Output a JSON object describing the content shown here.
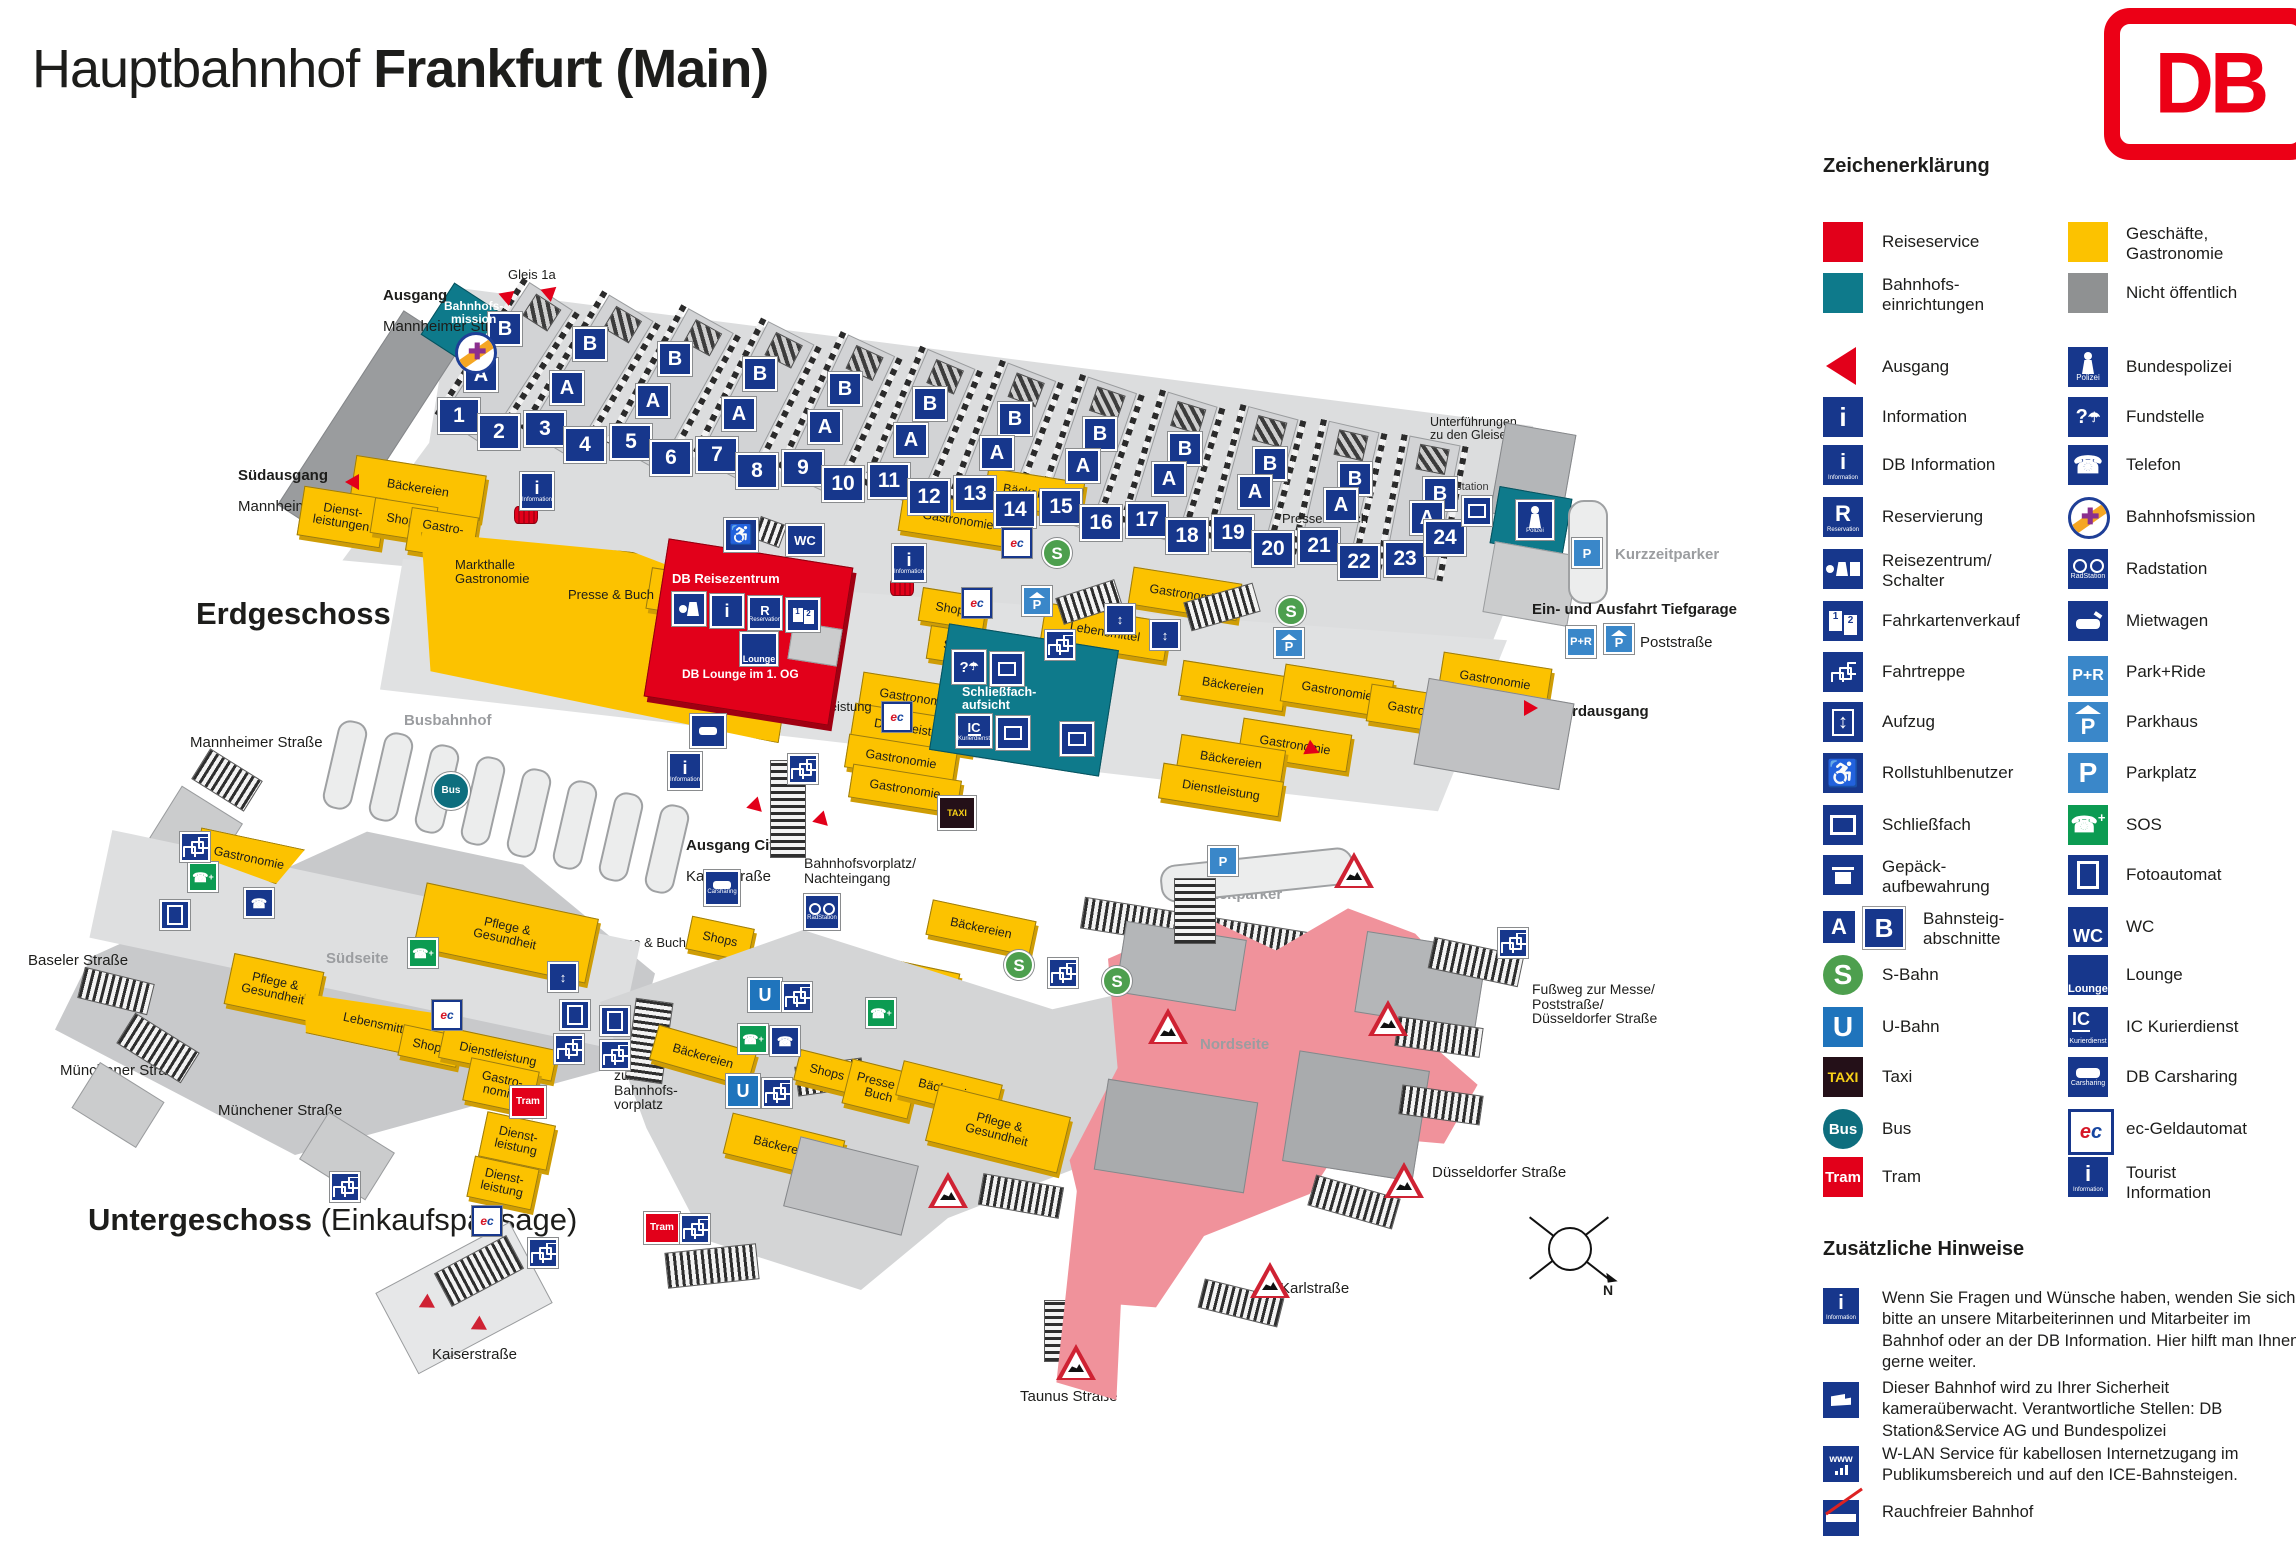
{
  "title": {
    "regular": "Hauptbahnhof ",
    "bold": "Frankfurt (Main)"
  },
  "logo": {
    "text": "DB"
  },
  "legend": {
    "heading": "Zeichenerklärung",
    "left": [
      {
        "icon": "reiseservice-swatch",
        "label": "Reiseservice"
      },
      {
        "icon": "bahnhofseinrichtungen-swatch",
        "label": "Bahnhofs-\neinrichtungen"
      },
      {
        "icon": "ausgang-arrow",
        "label": "Ausgang"
      },
      {
        "icon": "information",
        "label": "Information"
      },
      {
        "icon": "db-information",
        "label": "DB Information"
      },
      {
        "icon": "reservierung",
        "label": "Reservierung"
      },
      {
        "icon": "reisezentrum-schalter",
        "label": "Reisezentrum/\nSchalter"
      },
      {
        "icon": "fahrkartenverkauf",
        "label": "Fahrkartenverkauf"
      },
      {
        "icon": "fahrtreppe",
        "label": "Fahrtreppe"
      },
      {
        "icon": "aufzug",
        "label": "Aufzug"
      },
      {
        "icon": "rollstuhlbenutzer",
        "label": "Rollstuhlbenutzer"
      },
      {
        "icon": "schliessfach",
        "label": "Schließfach"
      },
      {
        "icon": "gepaeckaufbewahrung",
        "label": "Gepäck-\naufbewahrung"
      },
      {
        "icon": "bahnsteigabschnitte",
        "label": "Bahnsteig-\nabschnitte"
      },
      {
        "icon": "s-bahn",
        "label": "S-Bahn"
      },
      {
        "icon": "u-bahn",
        "label": "U-Bahn"
      },
      {
        "icon": "taxi",
        "label": "Taxi"
      },
      {
        "icon": "bus",
        "label": "Bus"
      },
      {
        "icon": "tram",
        "label": "Tram"
      }
    ],
    "right": [
      {
        "icon": "geschaefte-swatch",
        "label": "Geschäfte,\nGastronomie"
      },
      {
        "icon": "nicht-oeffentlich-swatch",
        "label": "Nicht öffentlich"
      },
      {
        "icon": "bundespolizei",
        "label": "Bundespolizei"
      },
      {
        "icon": "fundstelle",
        "label": "Fundstelle"
      },
      {
        "icon": "telefon",
        "label": "Telefon"
      },
      {
        "icon": "bahnhofsmission",
        "label": "Bahnhofsmission"
      },
      {
        "icon": "radstation",
        "label": "Radstation"
      },
      {
        "icon": "mietwagen",
        "label": "Mietwagen"
      },
      {
        "icon": "park-ride",
        "label": "Park+Ride"
      },
      {
        "icon": "parkhaus",
        "label": "Parkhaus"
      },
      {
        "icon": "parkplatz",
        "label": "Parkplatz"
      },
      {
        "icon": "sos",
        "label": "SOS"
      },
      {
        "icon": "fotoautomat",
        "label": "Fotoautomat"
      },
      {
        "icon": "wc",
        "label": "WC"
      },
      {
        "icon": "lounge",
        "label": "Lounge"
      },
      {
        "icon": "ic-kurierdienst",
        "label": "IC Kurierdienst"
      },
      {
        "icon": "db-carsharing",
        "label": "DB Carsharing"
      },
      {
        "icon": "ec-geldautomat",
        "label": "ec-Geldautomat"
      },
      {
        "icon": "tourist-information",
        "label": "Tourist\nInformation"
      }
    ]
  },
  "notes": {
    "heading": "Zusätzliche Hinweise",
    "items": [
      "Wenn Sie Fragen und Wünsche haben, wenden Sie sich bitte an unsere Mitarbeiterinnen und Mitarbeiter im Bahnhof oder an der DB Information. Hier hilft man Ihnen gerne weiter.",
      "Dieser Bahnhof wird zu Ihrer Sicherheit kameraüberwacht. Verantwortliche Stellen: DB Station&Service AG und Bundespolizei",
      "W-LAN Service für kabellosen Internetzugang im Publikumsbereich und auf den ICE-Bahnsteigen.",
      "Rauchfreier Bahnhof"
    ]
  },
  "icon_glyphs": {
    "i": "i",
    "r": "R",
    "p": "P",
    "pr": "P+R",
    "wc": "WC",
    "s": "S",
    "u": "U",
    "ic": "IC",
    "taxi": "TAXI",
    "bus": "Bus",
    "tram": "Tram",
    "e": "e",
    "c": "c",
    "lounge": "Lounge",
    "polizei": "Polizei",
    "information": "Information",
    "reservation": "Reservation",
    "radstation": "RadStation",
    "kurierdienst": "Kurierdienst",
    "carsharing": "Carsharing",
    "www": "www",
    "one": "1",
    "two": "2"
  },
  "map": {
    "floor_labels": {
      "erdgeschoss": "Erdgeschoss",
      "untergeschoss": "Untergeschoss",
      "einkaufspassage": " (Einkaufspassage)"
    },
    "platform_numbers": [
      "1",
      "2",
      "3",
      "4",
      "5",
      "6",
      "7",
      "8",
      "9",
      "10",
      "11",
      "12",
      "13",
      "14",
      "15",
      "16",
      "17",
      "18",
      "19",
      "20",
      "21",
      "22",
      "23",
      "24"
    ],
    "sections": {
      "a": "A",
      "b": "B"
    },
    "labels": {
      "gleis1a": "Gleis 1a",
      "ausgang": "Ausgang",
      "mannheimer": "Mannheimer Straße",
      "suedausgang": "Südausgang",
      "bahnhofsmission": "Bahnhofs-\nmission",
      "baeckereien": "Bäckereien",
      "lebensmittel": "Lebensmittel",
      "gastronomie": "Gastronomie",
      "gastronomie2": "Gastro-\nnomie",
      "markthalle": "Markthalle\nGastronomie",
      "presse_buch": "Presse & Buch",
      "shops": "Shops",
      "dienstleistung": "Dienstleistung",
      "dienstleistungen2": "Dienst-\nleistungen",
      "dienstleistung2": "Dienst-\nleistung",
      "pflege": "Pflege &\nGesundheit",
      "db_reisezentrum": "DB Reisezentrum",
      "db_lounge": "DB Lounge im 1. OG",
      "schliessfachaufsicht": "Schließfach-\naufsicht",
      "busbahnhof": "Busbahnhof",
      "unterfuehrungen": "Unterführungen\nzu den Gleisen",
      "kurzzeitparker": "Kurzzeitparker",
      "einausfahrt": "Ein- und Ausfahrt Tiefgarage",
      "poststrasse": "Poststraße",
      "nordausgang": "Nordausgang",
      "radstation": "Radstation",
      "ausgang_city": "Ausgang City",
      "kaiserstrasse": "Kaiserstraße",
      "bahnhofsvorplatz": "Bahnhofsvorplatz/\nNachteingang",
      "zum_vorplatz": "zum\nBahnhofs-\nvorplatz",
      "suedseite": "Südseite",
      "nordseite": "Nordseite",
      "baseler": "Baseler Straße",
      "muenchener": "Münchener Straße",
      "duesseldorfer": "Düsseldorfer Straße",
      "karlstrasse": "Karlstraße",
      "taunus": "Taunus Straße",
      "fussweg": "Fußweg zur Messe/\nPoststraße/\nDüsseldorfer Straße",
      "north": "N"
    }
  }
}
